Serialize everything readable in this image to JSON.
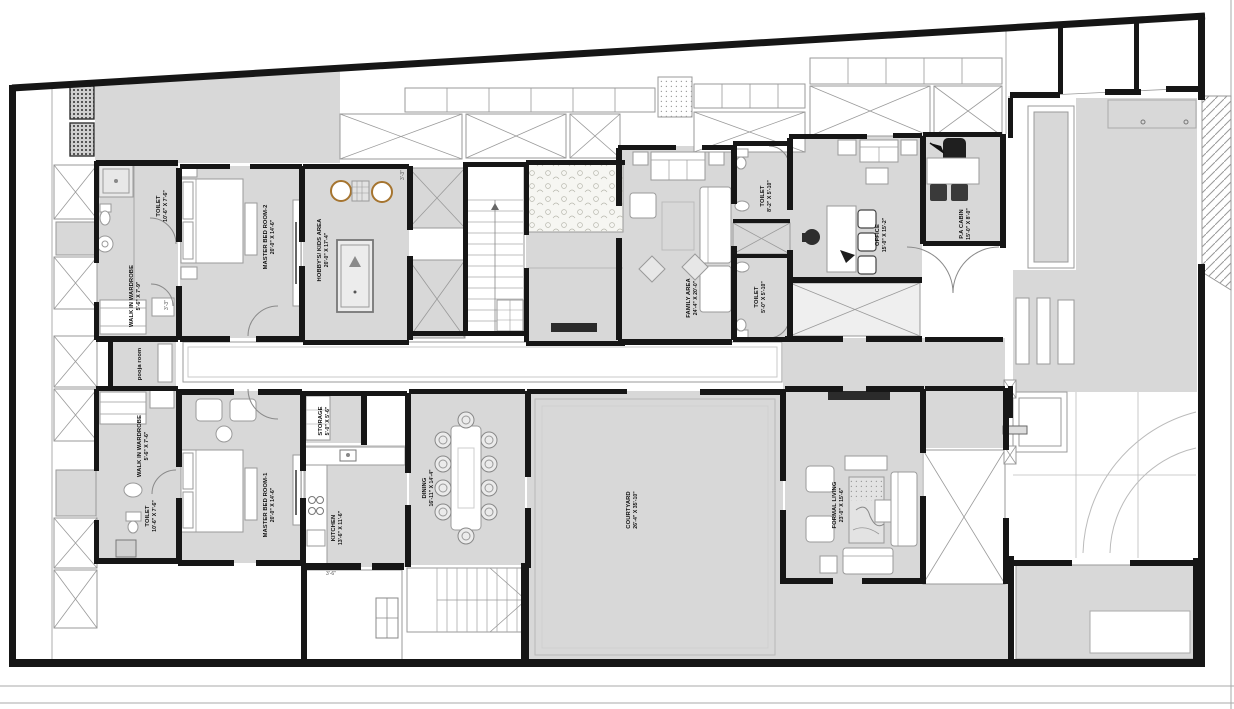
{
  "drawing": {
    "type": "residential floor plan"
  },
  "colors": {
    "floor_gray": "#d8d8d8",
    "wall_black": "#161616",
    "line_gray": "#9a9a9a",
    "door_gray": "#8a8a8a",
    "accent_brown": "#a5742f",
    "paper_white": "#ffffff"
  },
  "rooms": {
    "toilet_mbr2": {
      "name": "TOILET",
      "size": "10'-6\" X 7'-6\""
    },
    "wardrobe_mbr2": {
      "name": "WALK IN WARDROBE",
      "size": "5'-6\" X 7'-9\""
    },
    "pooja_room": {
      "name": "pooja room",
      "size": ""
    },
    "master_bed_room_2": {
      "name": "MASTER BED ROOM-2",
      "size": "20'-0\" X 14'-6\""
    },
    "hobbys_kids_area": {
      "name": "HOBBY'S/ KIDS AREA",
      "size": "20'-0\" X 17'-4\""
    },
    "family_area": {
      "name": "FAMILY AREA",
      "size": "24'-4\" X 20'-0\""
    },
    "toilet_family_top": {
      "name": "TOILET",
      "size": "8'-2\" X 5'-10\""
    },
    "toilet_family_bottom": {
      "name": "TOILET",
      "size": "5'-0\" X 5'-10\""
    },
    "office": {
      "name": "OFFICE",
      "size": "15'-0\" X 15'-2\""
    },
    "pa_cabin": {
      "name": "P.A CABIN",
      "size": "15'-0\" X 8'-0\""
    },
    "wardrobe_mbr1": {
      "name": "WALK IN WARDROBE",
      "size": "5'-6\" X 7'-6\""
    },
    "toilet_mbr1": {
      "name": "TOILET",
      "size": "10'-6\" X 7'-6\""
    },
    "master_bed_room_1": {
      "name": "MASTER BED ROOM-1",
      "size": "20'-0\" X 14'-6\""
    },
    "storage": {
      "name": "STORAGE",
      "size": "5'-0\" X 5'-6\""
    },
    "kitchen": {
      "name": "KITCHEN",
      "size": "13'-6\" X 11'-6\""
    },
    "dining": {
      "name": "DINING",
      "size": "16'-11\" X 14'-4\""
    },
    "courtyard": {
      "name": "COURTYARD",
      "size": "26'-4\" X 35'-10\""
    },
    "formal_living": {
      "name": "FORMAL LIVING",
      "size": "23'-0\" X 15'-6\""
    }
  },
  "dimension_notes": {
    "a": "3'-3\"",
    "b": "3'-3\"",
    "c": "3'-6\""
  }
}
